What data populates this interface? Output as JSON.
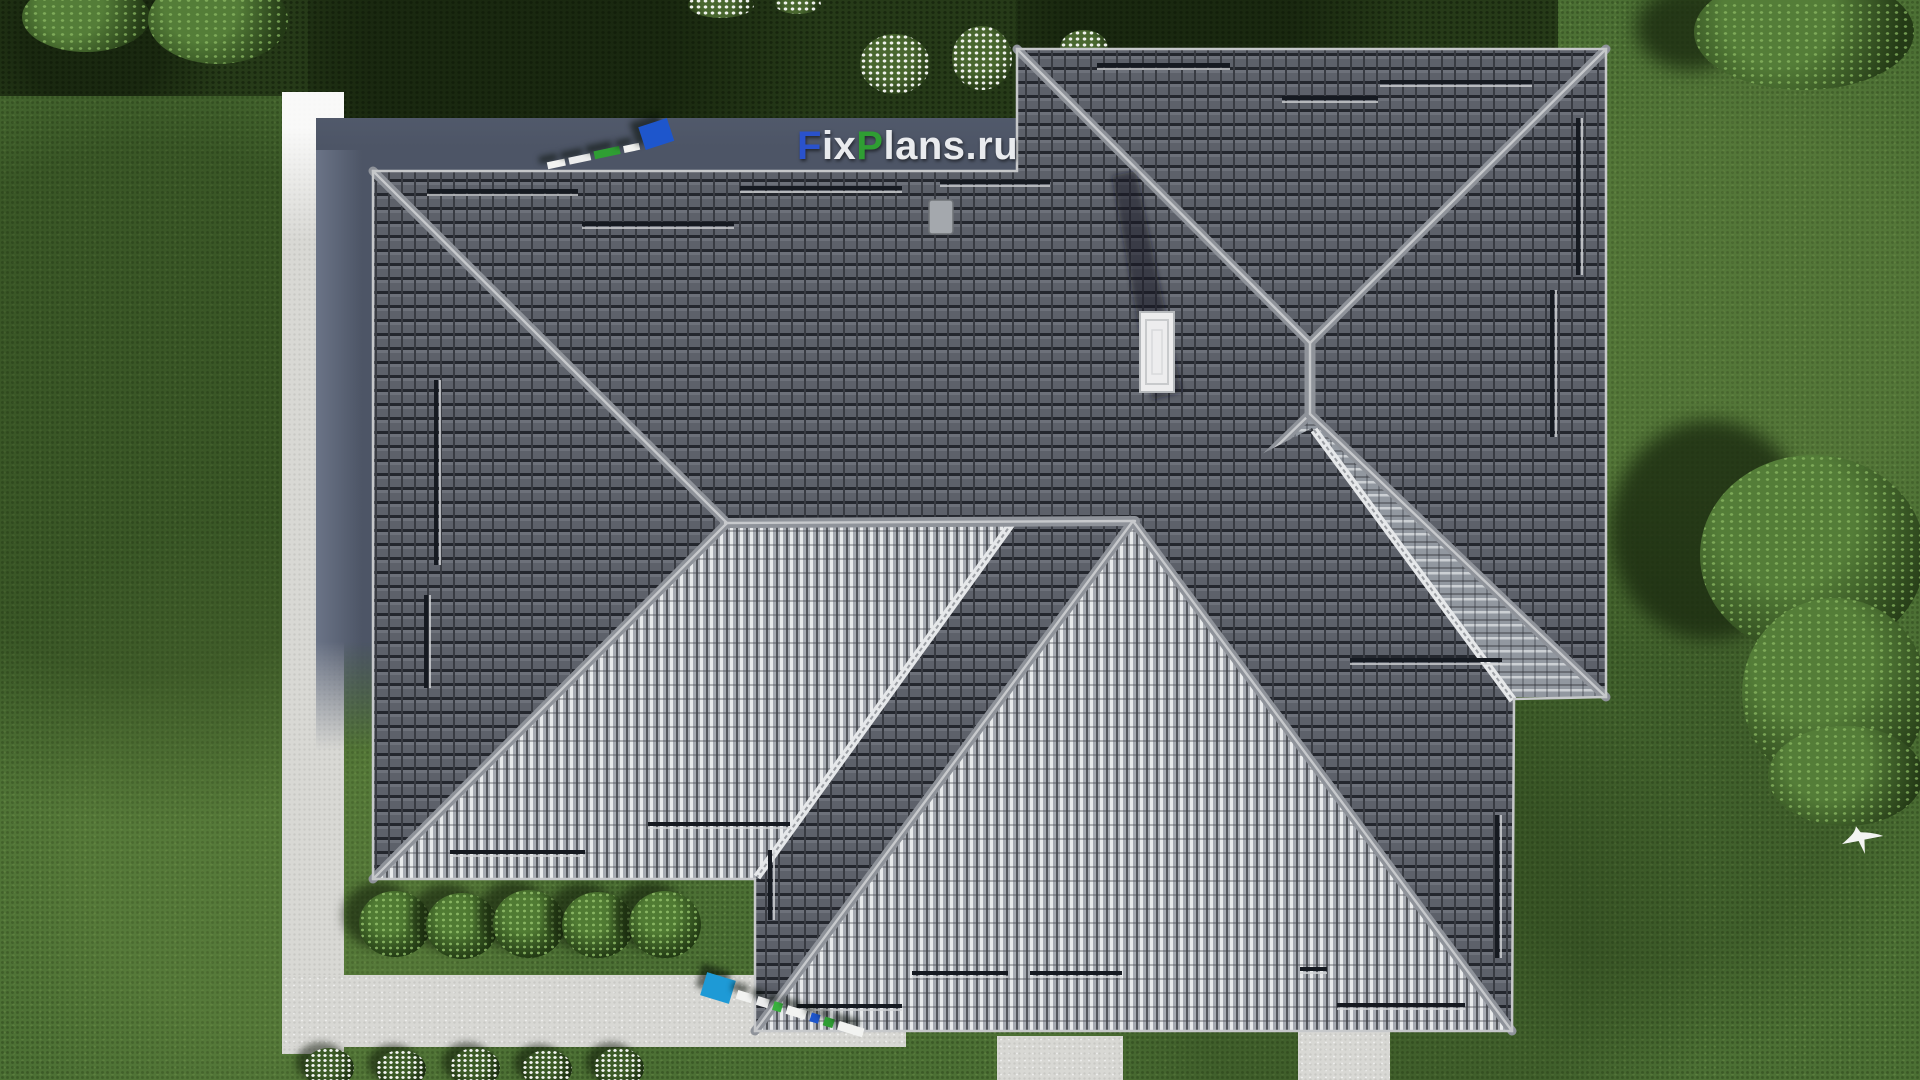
{
  "watermark": {
    "full_text": "FixPlans.ru",
    "f": "F",
    "ix": "ix",
    "p": "P",
    "lans": "lans",
    "dot_ru": ".ru",
    "color_blue": "#2a52cc",
    "color_green": "#2f9e33",
    "color_white": "#e9ebee"
  },
  "scene": {
    "subject": "aerial top view of hip roof house render",
    "roof": {
      "dark_tile_color": "#5d616a",
      "lit_rib_color": "#e9ebec",
      "ridge_color": "#8f939a",
      "valley_color": "#e6e8ea",
      "snow_guard_bars": 19,
      "roof_hatch": "white rectangular hatch",
      "roof_vent": "small gray vent"
    },
    "ground": {
      "lawn_color": "#4c7034",
      "shaded_lawn_color": "#263a18",
      "path_color": "#d8d8d4",
      "house_shadow_color": "#4d5566"
    },
    "vegetation": {
      "hedge_bushes_mid_row": 5,
      "flowering_bushes_bottom_row": 5,
      "white_flower_shrubs_top": 5,
      "tree_clusters": 4
    },
    "bird": "white bird flying over lawn"
  }
}
